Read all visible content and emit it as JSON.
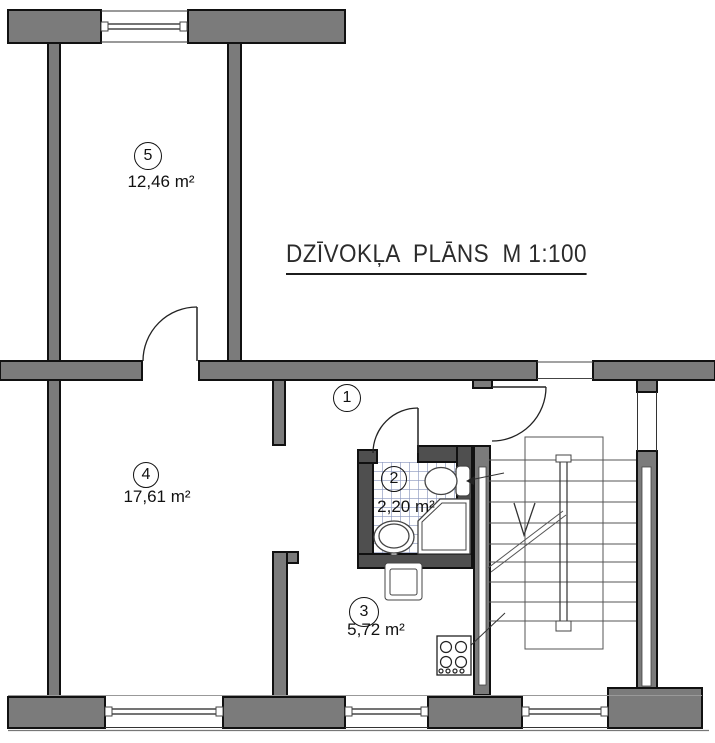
{
  "title": {
    "text": "DZĪVOKĻA  PLĀNS  M 1:100",
    "font_px": 25,
    "x": 286,
    "y": 240
  },
  "rooms": [
    {
      "number": "5",
      "area": "12,46 m²",
      "circle": {
        "cx": 148,
        "cy": 156,
        "r": 14
      },
      "area_pos": {
        "x": 161,
        "y": 182
      }
    },
    {
      "number": "4",
      "area": "17,61 m²",
      "circle": {
        "cx": 146,
        "cy": 475,
        "r": 13
      },
      "area_pos": {
        "x": 157,
        "y": 497
      }
    },
    {
      "number": "1",
      "area": "",
      "circle": {
        "cx": 347,
        "cy": 398,
        "r": 14
      },
      "area_pos": null
    },
    {
      "number": "2",
      "area": "2,20 m²",
      "circle": {
        "cx": 394,
        "cy": 479,
        "r": 13
      },
      "area_pos": {
        "x": 406,
        "y": 507
      }
    },
    {
      "number": "3",
      "area": "5,72 m²",
      "circle": {
        "cx": 364,
        "cy": 612,
        "r": 15
      },
      "area_pos": {
        "x": 376,
        "y": 630
      }
    }
  ],
  "colors": {
    "wall_main": "#7b7b7b",
    "wall_dark": "#4f4f4f",
    "outline": "#111111",
    "thin": "#333333",
    "step": "#555555",
    "fixture": "#444444",
    "tile_line": "#8c98be",
    "text": "#111111"
  },
  "plan": {
    "size": {
      "w": 715,
      "h": 743
    },
    "tiles": {
      "name": "bathroom-tile-floor",
      "x": 373,
      "y": 462,
      "w": 84,
      "h": 92
    },
    "walls": [
      {
        "n": "wall-top-left",
        "x": 8,
        "y": 10,
        "w": 93,
        "h": 33,
        "tone": "main"
      },
      {
        "n": "wall-top-center",
        "x": 188,
        "y": 10,
        "w": 157,
        "h": 33,
        "tone": "main"
      },
      {
        "n": "wall-left-exterior",
        "x": 48,
        "y": 43,
        "w": 12,
        "h": 654,
        "tone": "main"
      },
      {
        "n": "wall-room5-right",
        "x": 228,
        "y": 43,
        "w": 13,
        "h": 318,
        "tone": "main"
      },
      {
        "n": "wall-middle-left",
        "x": 0,
        "y": 361,
        "w": 142,
        "h": 19,
        "tone": "main"
      },
      {
        "n": "wall-middle-center",
        "x": 199,
        "y": 361,
        "w": 338,
        "h": 19,
        "tone": "main"
      },
      {
        "n": "wall-middle-right",
        "x": 593,
        "y": 361,
        "w": 122,
        "h": 19,
        "tone": "main"
      },
      {
        "n": "wall-entry-stub",
        "x": 473,
        "y": 380,
        "w": 19,
        "h": 8,
        "tone": "main"
      },
      {
        "n": "wall-right-stub",
        "x": 637,
        "y": 380,
        "w": 20,
        "h": 12,
        "tone": "main"
      },
      {
        "n": "wall-stair-right",
        "x": 637,
        "y": 451,
        "w": 20,
        "h": 244,
        "tone": "main"
      },
      {
        "n": "wall-corner-bottom-right",
        "x": 608,
        "y": 688,
        "w": 94,
        "h": 40,
        "tone": "main"
      },
      {
        "n": "wall-bottom-a",
        "x": 8,
        "y": 697,
        "w": 97,
        "h": 31,
        "tone": "main"
      },
      {
        "n": "wall-bottom-b",
        "x": 223,
        "y": 697,
        "w": 122,
        "h": 31,
        "tone": "main"
      },
      {
        "n": "wall-bottom-c",
        "x": 428,
        "y": 697,
        "w": 94,
        "h": 31,
        "tone": "main"
      },
      {
        "n": "wall-room4-stub",
        "x": 273,
        "y": 380,
        "w": 12,
        "h": 65,
        "tone": "main"
      },
      {
        "n": "wall-room4-cap",
        "x": 273,
        "y": 552,
        "w": 25,
        "h": 11,
        "tone": "main"
      },
      {
        "n": "wall-room4-room3",
        "x": 273,
        "y": 552,
        "w": 14,
        "h": 145,
        "tone": "main"
      },
      {
        "n": "wall-stair-left",
        "x": 474,
        "y": 446,
        "w": 16,
        "h": 249,
        "tone": "main"
      },
      {
        "n": "wall-bath-left",
        "x": 358,
        "y": 450,
        "w": 15,
        "h": 118,
        "tone": "dark"
      },
      {
        "n": "wall-bath-top-left",
        "x": 358,
        "y": 450,
        "w": 19,
        "h": 13,
        "tone": "dark"
      },
      {
        "n": "wall-bath-top-right",
        "x": 418,
        "y": 446,
        "w": 54,
        "h": 16,
        "tone": "dark"
      },
      {
        "n": "wall-bath-right",
        "x": 457,
        "y": 446,
        "w": 15,
        "h": 122,
        "tone": "dark"
      },
      {
        "n": "wall-bath-bottom",
        "x": 358,
        "y": 554,
        "w": 114,
        "h": 14,
        "tone": "dark"
      }
    ],
    "slots": [
      {
        "n": "stair-right-wall-window",
        "x": 642,
        "y": 467,
        "w": 9,
        "h": 219
      },
      {
        "n": "stair-left-wall-window",
        "x": 479,
        "y": 467,
        "w": 7,
        "h": 218
      }
    ],
    "lines": [
      [
        101,
        11,
        188,
        11,
        1,
        "#333",
        "window-face"
      ],
      [
        101,
        42,
        188,
        42,
        1,
        "#333",
        "window-face"
      ],
      [
        101,
        24,
        188,
        24,
        1.2,
        "#222",
        "window-glazing"
      ],
      [
        101,
        29,
        188,
        29,
        1.2,
        "#222",
        "window-glazing"
      ],
      [
        8,
        695.5,
        702,
        695.5,
        1,
        "#999",
        "wall-face-line"
      ],
      [
        8,
        730.5,
        709,
        730.5,
        1.2,
        "#777",
        "wall-face-line"
      ],
      [
        105,
        709,
        223,
        709,
        1.2,
        "#222",
        "window-glazing"
      ],
      [
        105,
        714,
        223,
        714,
        1.2,
        "#222",
        "window-glazing"
      ],
      [
        105,
        727.5,
        223,
        727.5,
        1,
        "#333",
        "window-face"
      ],
      [
        345,
        709,
        428,
        709,
        1.2,
        "#222",
        "window-glazing"
      ],
      [
        345,
        714,
        428,
        714,
        1.2,
        "#222",
        "window-glazing"
      ],
      [
        345,
        727.5,
        428,
        727.5,
        1,
        "#333",
        "window-face"
      ],
      [
        522,
        709,
        608,
        709,
        1.2,
        "#222",
        "window-glazing"
      ],
      [
        522,
        714,
        608,
        714,
        1.2,
        "#222",
        "window-glazing"
      ],
      [
        522,
        727.5,
        608,
        727.5,
        1,
        "#333",
        "window-face"
      ],
      [
        637.5,
        392,
        637.5,
        451,
        1,
        "#333",
        "stair-opening-side"
      ],
      [
        656.5,
        392,
        656.5,
        451,
        1,
        "#333",
        "stair-opening-side"
      ],
      [
        537,
        362,
        593,
        362,
        1,
        "#444",
        "entrance-opening-face"
      ],
      [
        537,
        378.5,
        593,
        378.5,
        1,
        "#444",
        "entrance-opening-face"
      ],
      [
        489,
        460,
        636,
        460,
        1,
        "#555",
        "stair-step"
      ],
      [
        489,
        481,
        636,
        481,
        1,
        "#555",
        "stair-step"
      ],
      [
        489,
        502,
        636,
        502,
        1,
        "#555",
        "stair-step"
      ],
      [
        489,
        523,
        636,
        523,
        1,
        "#555",
        "stair-step"
      ],
      [
        489,
        544,
        636,
        544,
        1,
        "#555",
        "stair-step"
      ],
      [
        489,
        562,
        636,
        562,
        1,
        "#555",
        "stair-step"
      ],
      [
        489,
        582,
        636,
        582,
        1,
        "#555",
        "stair-step"
      ],
      [
        489,
        602,
        636,
        602,
        1,
        "#555",
        "stair-step"
      ],
      [
        489,
        621,
        636,
        621,
        1,
        "#555",
        "stair-step"
      ],
      [
        560,
        458,
        560,
        625,
        1.2,
        "#333",
        "stair-railing"
      ],
      [
        567,
        458,
        567,
        625,
        1.2,
        "#333",
        "stair-railing"
      ],
      [
        488,
        568,
        563,
        511,
        1,
        "#555",
        "stair-flight-line"
      ],
      [
        491,
        572,
        566,
        515,
        1,
        "#555",
        "stair-flight-line"
      ],
      [
        450,
        665,
        505,
        613,
        1,
        "#333",
        "leader-line"
      ],
      [
        470,
        480,
        504,
        473,
        1,
        "#333",
        "toilet-arrow-line"
      ],
      [
        197,
        307,
        197,
        361,
        1.5,
        "#222",
        "door-leaf-room5"
      ],
      [
        418,
        408,
        418,
        453,
        1.5,
        "#222",
        "door-leaf-bathroom"
      ],
      [
        492,
        387,
        546,
        387,
        1.5,
        "#222",
        "door-leaf-entrance"
      ],
      [
        396,
        565,
        410,
        565,
        3,
        "#444",
        "kitchen-faucet-bar"
      ],
      [
        403,
        567,
        403,
        581,
        2,
        "#444",
        "kitchen-faucet-stem"
      ]
    ],
    "thin_rects": [
      {
        "n": "window-end-cap",
        "x": 101,
        "y": 22,
        "w": 7,
        "h": 9,
        "f": "#fff"
      },
      {
        "n": "window-end-cap",
        "x": 180,
        "y": 22,
        "w": 7,
        "h": 9,
        "f": "#fff"
      },
      {
        "n": "window-end-cap",
        "x": 105,
        "y": 707,
        "w": 7,
        "h": 9,
        "f": "#fff"
      },
      {
        "n": "window-end-cap",
        "x": 216,
        "y": 707,
        "w": 7,
        "h": 9,
        "f": "#fff"
      },
      {
        "n": "window-end-cap",
        "x": 345,
        "y": 707,
        "w": 7,
        "h": 9,
        "f": "#fff"
      },
      {
        "n": "window-end-cap",
        "x": 421,
        "y": 707,
        "w": 7,
        "h": 9,
        "f": "#fff"
      },
      {
        "n": "window-end-cap",
        "x": 522,
        "y": 707,
        "w": 7,
        "h": 9,
        "f": "#fff"
      },
      {
        "n": "window-end-cap",
        "x": 601,
        "y": 707,
        "w": 7,
        "h": 9,
        "f": "#fff"
      },
      {
        "n": "railing-cap",
        "x": 556,
        "y": 455,
        "w": 15,
        "h": 7,
        "f": "#fff"
      },
      {
        "n": "railing-cap",
        "x": 556,
        "y": 621,
        "w": 15,
        "h": 10,
        "f": "#fff"
      },
      {
        "n": "stair-landing",
        "x": 525,
        "y": 437,
        "w": 78,
        "h": 212,
        "f": "none"
      },
      {
        "n": "toilet-tank",
        "x": 456,
        "y": 466,
        "w": 14,
        "h": 30,
        "f": "#fff",
        "r": 4
      },
      {
        "n": "kitchen-sink-outer",
        "x": 385,
        "y": 563,
        "w": 37,
        "h": 37,
        "f": "#fff",
        "r": 3
      },
      {
        "n": "kitchen-sink-inner",
        "x": 390,
        "y": 569,
        "w": 27,
        "h": 26,
        "f": "#fff",
        "r": 2
      },
      {
        "n": "bath-sink-tap",
        "x": 391,
        "y": 546,
        "w": 6,
        "h": 9,
        "f": "#fff"
      },
      {
        "n": "stove",
        "x": 437,
        "y": 636,
        "w": 34,
        "h": 39,
        "f": "#fff"
      }
    ],
    "paths": [
      {
        "n": "door-arc-room5",
        "d": "M143,361 A54,54 0 0 1 197,307"
      },
      {
        "n": "door-arc-bathroom",
        "d": "M373,453 A45,45 0 0 1 418,408"
      },
      {
        "n": "door-arc-entrance",
        "d": "M546,387 A54,54 0 0 1 492,441"
      }
    ],
    "ellipses": [
      {
        "n": "toilet-bowl",
        "cx": 441,
        "cy": 481,
        "rx": 16,
        "ry": 13.5
      },
      {
        "n": "bath-sink-outer",
        "cx": 394,
        "cy": 537,
        "rx": 20,
        "ry": 16
      },
      {
        "n": "bath-sink-inner",
        "cx": 394,
        "cy": 536,
        "rx": 15,
        "ry": 12
      }
    ],
    "circles": [
      {
        "n": "shower-drain",
        "cx": 446,
        "cy": 528,
        "r": 3,
        "c": "#444"
      },
      {
        "n": "stove-burner",
        "cx": 446,
        "cy": 647,
        "r": 5.5,
        "c": "#222"
      },
      {
        "n": "stove-burner",
        "cx": 461,
        "cy": 647,
        "r": 5.5,
        "c": "#222"
      },
      {
        "n": "stove-burner",
        "cx": 446,
        "cy": 662,
        "r": 5.5,
        "c": "#222"
      },
      {
        "n": "stove-burner",
        "cx": 461,
        "cy": 662,
        "r": 5.5,
        "c": "#222"
      },
      {
        "n": "stove-knob",
        "cx": 441,
        "cy": 671,
        "r": 2,
        "c": "#222"
      },
      {
        "n": "stove-knob",
        "cx": 448,
        "cy": 671,
        "r": 2,
        "c": "#222"
      },
      {
        "n": "stove-knob",
        "cx": 455,
        "cy": 671,
        "r": 2,
        "c": "#222"
      },
      {
        "n": "stove-knob",
        "cx": 462,
        "cy": 671,
        "r": 2,
        "c": "#222"
      }
    ],
    "polygons": [
      {
        "n": "shower-tray-outer",
        "pts": "440,499 470,499 470,554 418,554 418,521",
        "f": "#fff",
        "c": "#444",
        "w": 1.3
      },
      {
        "n": "shower-tray-inner",
        "pts": "442,503 466,503 466,550 422,550 422,522",
        "f": "none",
        "c": "#444",
        "w": 1
      },
      {
        "n": "toilet-arrowhead",
        "pts": "466,481 475,476 474,485",
        "f": "#222",
        "c": "none",
        "w": 0
      }
    ],
    "polylines": [
      {
        "n": "stair-direction-arrow",
        "pts": "514,503 524,535 535,503",
        "c": "#333",
        "w": 1.3
      }
    ]
  }
}
